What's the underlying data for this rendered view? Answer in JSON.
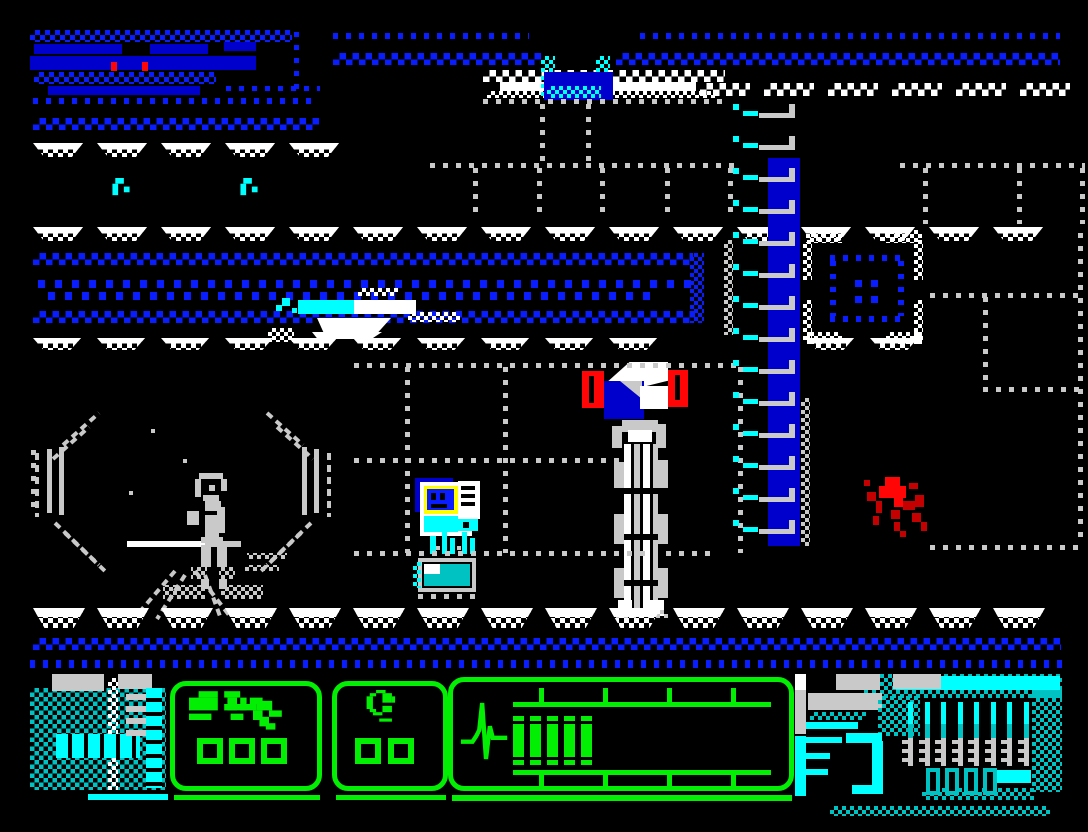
{
  "meta": {
    "type": "zx-spectrum-arcade-game-screenshot",
    "scene": "Industrial sci-fi corridor: octagonal teleporter ring with a figure inside, computer console with face on screen, machine pillar topped by a red beacon, blue wall ladder, blood splat on wall; green wireframe HUD with weapon panel, item panel and vitals bar over cyan machinery",
    "width": 1088,
    "height": 832
  },
  "palette": {
    "black": "#000000",
    "blue": "#0000cd",
    "bblue": "#0a1dff",
    "cyan": "#00c2c2",
    "bcyan": "#00ffff",
    "green": "#00c400",
    "bgreen": "#02ee02",
    "white": "#ffffff",
    "gray": "#c9c9c9",
    "red": "#c40000",
    "bred": "#ff0505",
    "yellow": "#ffff00"
  },
  "scene": {
    "positions": {
      "teleporter": {
        "x": 33,
        "y": 403
      },
      "console": {
        "x": 413,
        "y": 476
      },
      "pillar": {
        "x": 580,
        "y": 362
      },
      "ship": {
        "x": 266,
        "y": 283
      },
      "splat": {
        "x": 855,
        "y": 468
      },
      "hatch": {
        "x": 541,
        "y": 56
      },
      "vent": {
        "x": 803,
        "y": 228
      }
    },
    "ledge_rows": [
      {
        "y": 83,
        "x0": 700,
        "x1": 1072,
        "period": 64,
        "w": 50,
        "h": 13,
        "style": "zig"
      },
      {
        "y": 143,
        "x0": 33,
        "x1": 342,
        "period": 64,
        "w": 50,
        "h": 14,
        "style": "ledge"
      },
      {
        "y": 227,
        "x0": 33,
        "x1": 1060,
        "period": 64,
        "w": 50,
        "h": 14,
        "style": "ledge"
      },
      {
        "y": 338,
        "x0": 33,
        "x1": 700,
        "period": 64,
        "w": 48,
        "h": 12,
        "style": "ledge"
      },
      {
        "y": 338,
        "x0": 806,
        "x1": 930,
        "period": 64,
        "w": 48,
        "h": 12,
        "style": "ledge"
      },
      {
        "y": 608,
        "x0": 33,
        "x1": 1060,
        "period": 64,
        "w": 52,
        "h": 20,
        "style": "ledge"
      }
    ],
    "grid": {
      "rails": [
        {
          "x": 430,
          "y": 163,
          "w": 308
        },
        {
          "x": 900,
          "y": 163,
          "w": 185
        },
        {
          "x": 483,
          "y": 99,
          "w": 243
        },
        {
          "x": 354,
          "y": 363,
          "w": 388
        },
        {
          "x": 354,
          "y": 458,
          "w": 266
        },
        {
          "x": 354,
          "y": 551,
          "w": 356
        },
        {
          "x": 930,
          "y": 293,
          "w": 156
        },
        {
          "x": 983,
          "y": 387,
          "w": 103
        },
        {
          "x": 930,
          "y": 545,
          "w": 156
        }
      ],
      "posts": [
        {
          "x": 473,
          "y": 168,
          "h": 50
        },
        {
          "x": 537,
          "y": 168,
          "h": 50
        },
        {
          "x": 600,
          "y": 168,
          "h": 50
        },
        {
          "x": 665,
          "y": 168,
          "h": 50
        },
        {
          "x": 728,
          "y": 168,
          "h": 50
        },
        {
          "x": 923,
          "y": 168,
          "h": 56
        },
        {
          "x": 1017,
          "y": 168,
          "h": 56
        },
        {
          "x": 1080,
          "y": 168,
          "h": 56
        },
        {
          "x": 540,
          "y": 104,
          "h": 60
        },
        {
          "x": 586,
          "y": 104,
          "h": 60
        },
        {
          "x": 405,
          "y": 367,
          "h": 186
        },
        {
          "x": 503,
          "y": 367,
          "h": 186
        },
        {
          "x": 738,
          "y": 367,
          "h": 186
        },
        {
          "x": 983,
          "y": 297,
          "h": 90
        },
        {
          "x": 1078,
          "y": 233,
          "h": 312
        },
        {
          "x": 31,
          "y": 450,
          "h": 62
        }
      ]
    },
    "ladder": {
      "column": {
        "x": 768,
        "y": 158,
        "w": 32,
        "h": 388
      },
      "rungs": {
        "count": 14,
        "x": 733,
        "y0": 104,
        "dy": 32
      }
    }
  },
  "hud": {
    "weapon_panel": {
      "icon": "pistol-icon",
      "slots": 3
    },
    "item_panel": {
      "icon": "device-icon",
      "slots": 2
    },
    "vitals_panel": {
      "icon": "heartbeat-icon",
      "bar_segments_filled": 5,
      "ruler_ticks": 4
    },
    "engine": {
      "forks": 8,
      "cartridges": 4
    }
  }
}
